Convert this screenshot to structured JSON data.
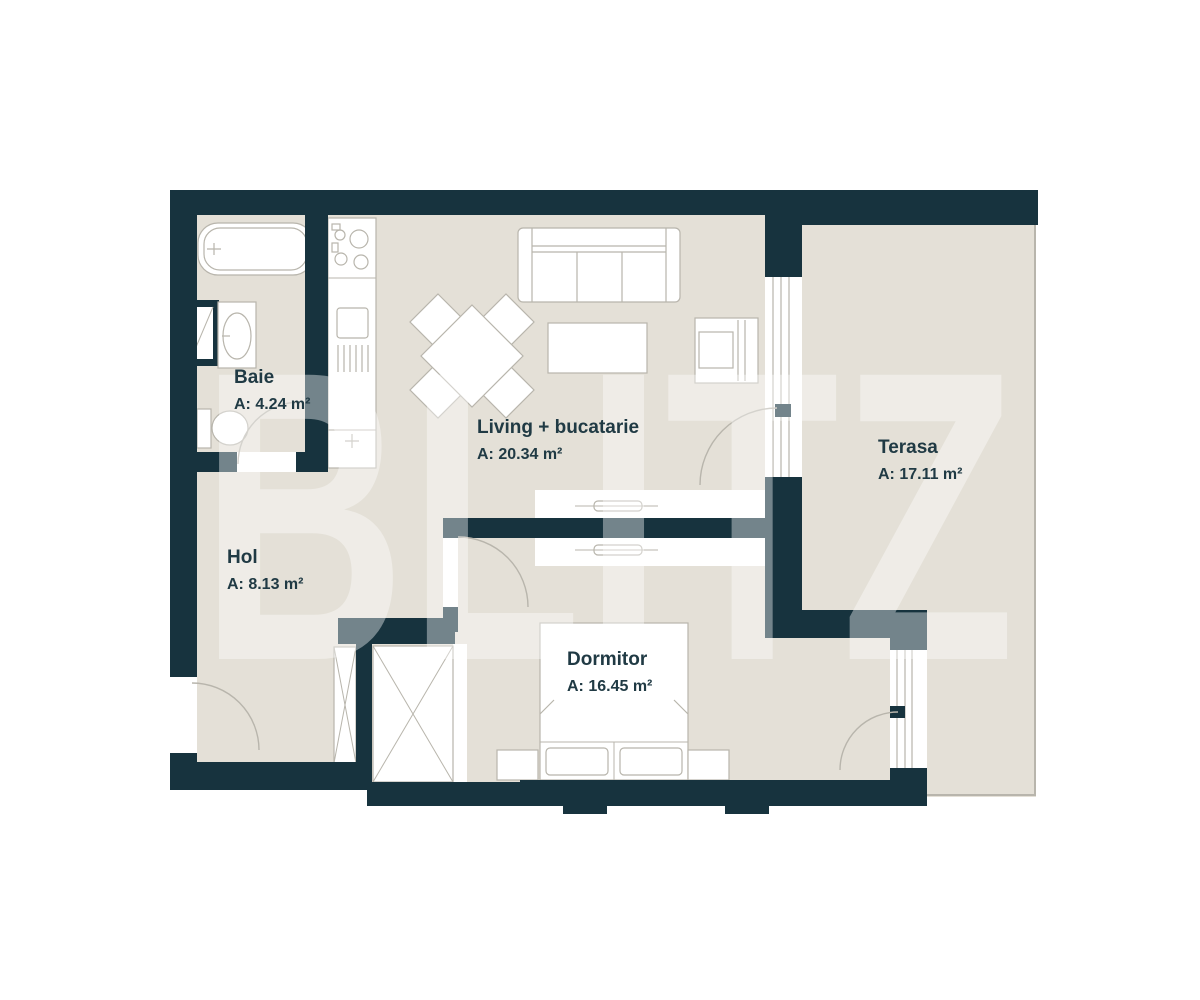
{
  "watermark": "BLITZ",
  "colors": {
    "wall": "#17333e",
    "floor": "#e4e0d7",
    "line": "#b8b5ac",
    "text": "#203a44",
    "watermark": "rgba(255,255,255,0.40)"
  },
  "rooms": [
    {
      "id": "baie",
      "name": "Baie",
      "area": "A: 4.24 m²"
    },
    {
      "id": "living",
      "name": "Living + bucatarie",
      "area": "A: 20.34 m²"
    },
    {
      "id": "terasa",
      "name": "Terasa",
      "area": "A: 17.11 m²"
    },
    {
      "id": "hol",
      "name": "Hol",
      "area": "A: 8.13 m²"
    },
    {
      "id": "dormitor",
      "name": "Dormitor",
      "area": "A: 16.45 m²"
    }
  ]
}
